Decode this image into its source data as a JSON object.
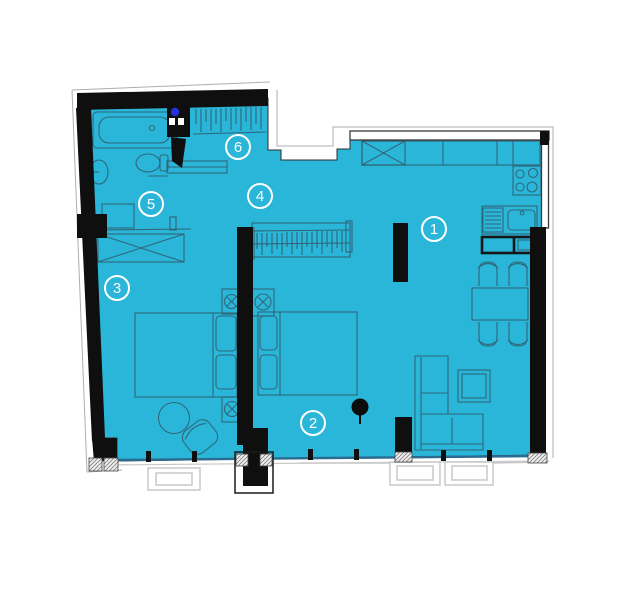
{
  "title": "Apartment floor plan",
  "rooms": [
    {
      "number": "1",
      "name": "kitchen-living-room"
    },
    {
      "number": "2",
      "name": "bedroom-2"
    },
    {
      "number": "3",
      "name": "bedroom-1"
    },
    {
      "number": "4",
      "name": "hallway"
    },
    {
      "number": "5",
      "name": "inner-hall"
    },
    {
      "number": "6",
      "name": "entry"
    }
  ],
  "colors": {
    "bg": "#ffffff",
    "floor": "#29b6d8",
    "wall": "#0f0f0f",
    "furn": "#33596b",
    "window": "#2a6b92",
    "sill": "#c9c9c9",
    "ext": "#aeaeae",
    "balcony": "#c4c4c4",
    "marker": "#ffffff",
    "dot": "#2431de"
  }
}
